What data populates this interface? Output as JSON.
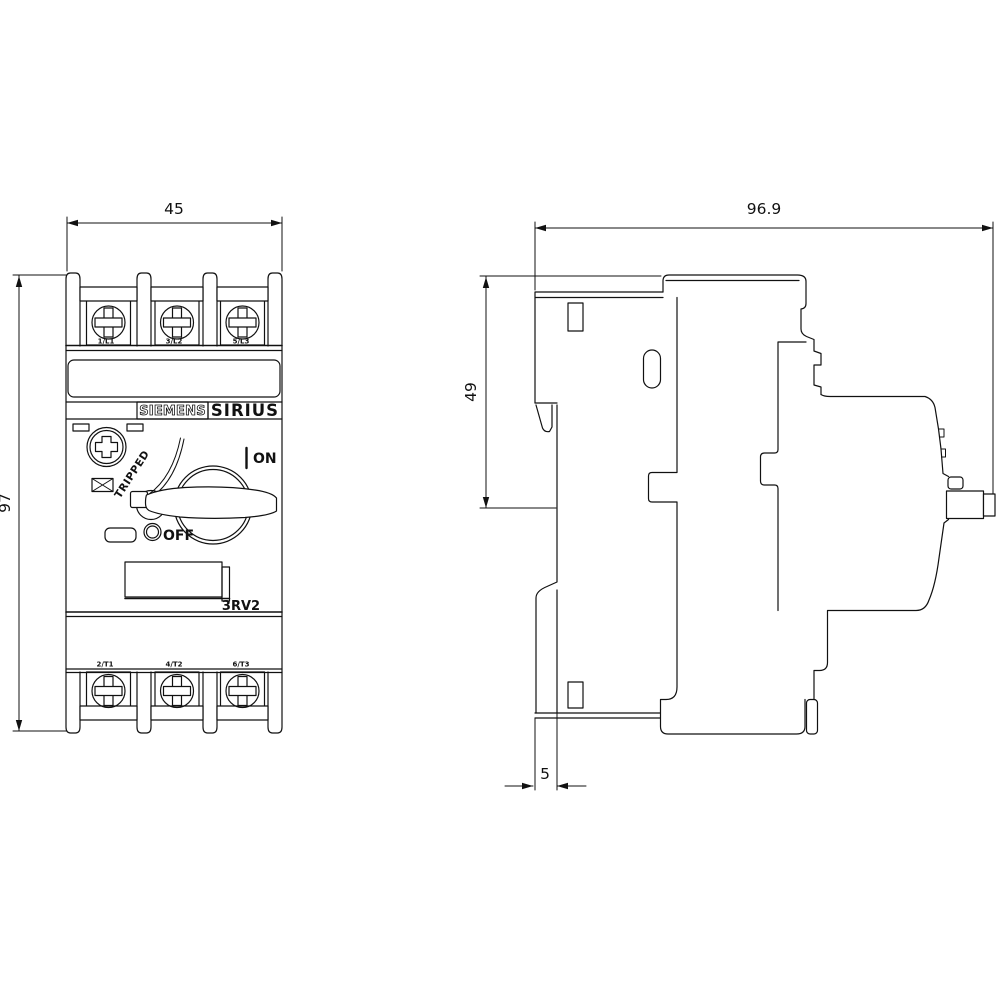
{
  "front_view": {
    "width_dim": "45",
    "height_dim": "97",
    "brand": "SIEMENS",
    "series": "SIRIUS",
    "model": "3RV2",
    "tripped_label": "TRIPPED",
    "on_label": "ON",
    "off_label": "OFF",
    "top_terminals": [
      "1/L1",
      "3/L2",
      "5/L3"
    ],
    "bottom_terminals": [
      "2/T1",
      "4/T2",
      "6/T3"
    ]
  },
  "side_view": {
    "depth_dim": "96.9",
    "mount_height_dim": "49",
    "rail_offset_dim": "5"
  },
  "colors": {
    "line": "#111111",
    "background": "#ffffff"
  }
}
